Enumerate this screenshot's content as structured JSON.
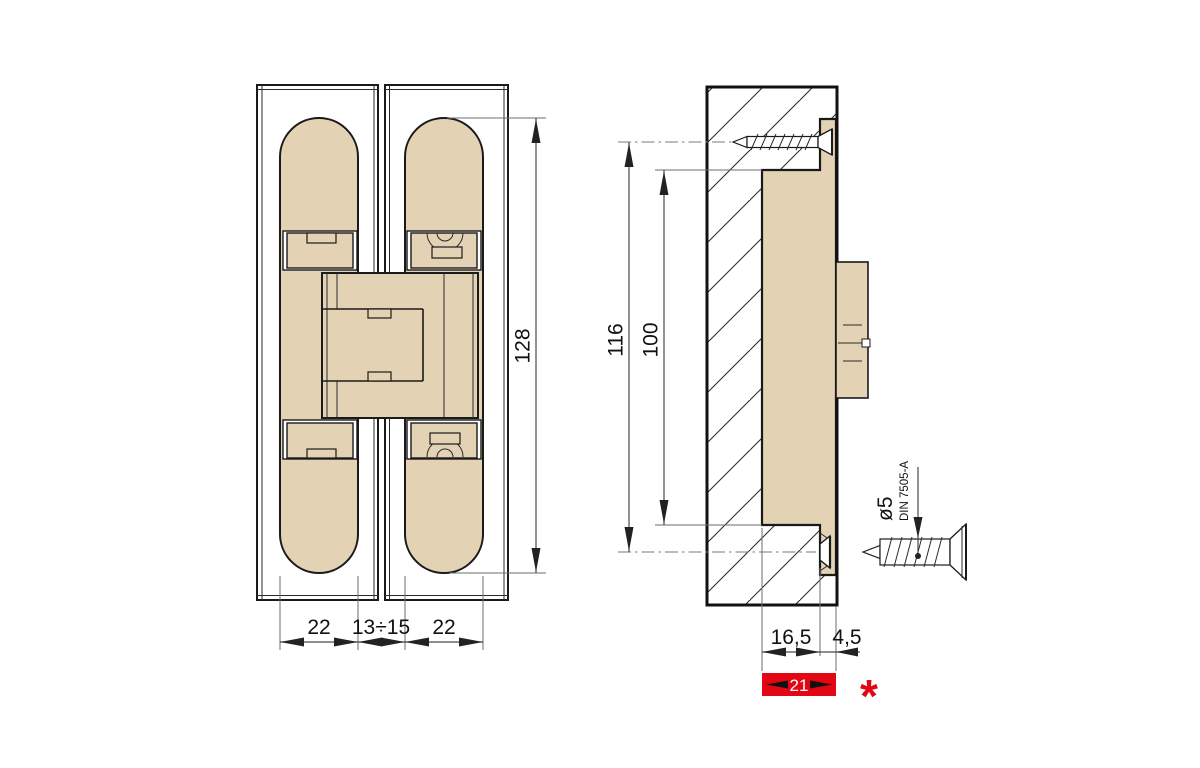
{
  "drawing": {
    "title": "concealed-hinge-technical-drawing",
    "front_view": {
      "dim_body_width_left": "22",
      "dim_center_gap": "13÷15",
      "dim_body_width_right": "22",
      "dim_total_length": "128"
    },
    "side_view": {
      "dim_screw_spacing": "116",
      "dim_body_length": "100",
      "dim_mortise_depth": "16,5",
      "dim_face_offset": "4,5",
      "dim_total_depth": "21",
      "footnote_marker": "*"
    },
    "screw_detail": {
      "diameter_label": "ø5",
      "standard_label": "DIN 7505-A"
    },
    "colors": {
      "body_fill": "#e3d2b4",
      "highlight_red": "#e30613",
      "outline": "#1a1a1a"
    }
  }
}
